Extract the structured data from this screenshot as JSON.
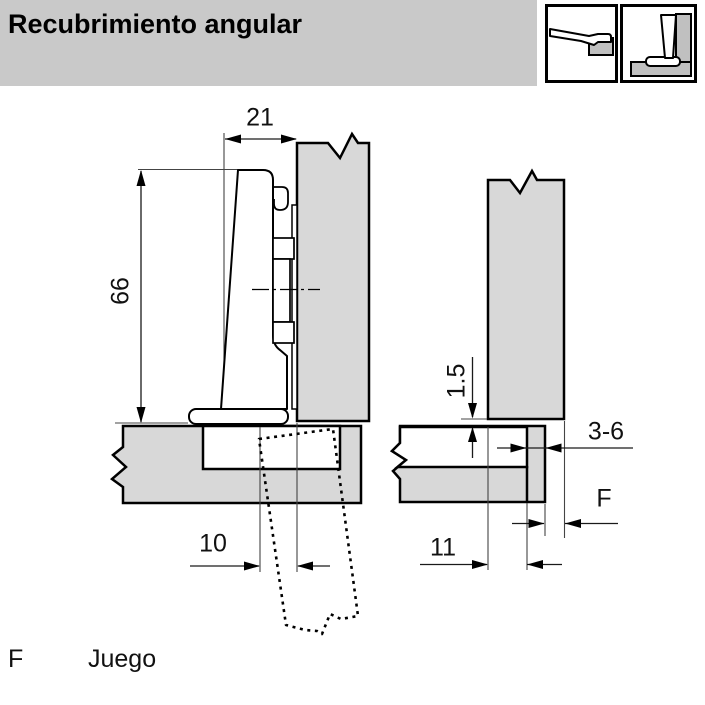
{
  "header": {
    "title": "Recubrimiento angular"
  },
  "icons": {
    "left_icon": "hinge-arm-side-view",
    "right_icon": "hinge-mounted-cross-section"
  },
  "diagram": {
    "left_view": {
      "width": "21",
      "height": "66",
      "offset": "10"
    },
    "right_view": {
      "gap": "1.5",
      "edge_band": "3-6",
      "clearance_symbol": "F",
      "depth": "11"
    }
  },
  "legend": {
    "symbol": "F",
    "meaning": "Juego"
  },
  "colors": {
    "header_bg": "#c9c9c9",
    "panel_fill": "#d8d8d8",
    "icon_plate_fill": "#c0c0c0",
    "line": "#000000"
  }
}
